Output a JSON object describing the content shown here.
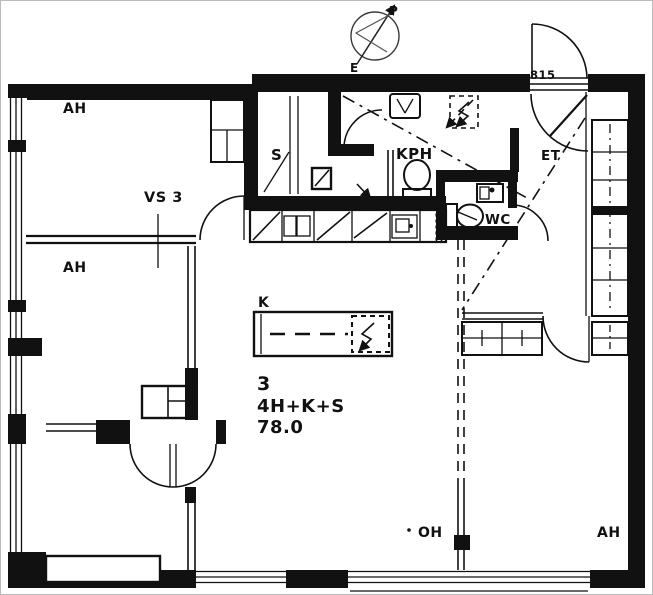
{
  "plan": {
    "compass": {
      "north": "P",
      "south": "E"
    },
    "entry_door_code": "815",
    "rooms": {
      "bedroom_top_left": "AH",
      "bedroom_mid_left": "AH",
      "bedroom_bottom_right": "AH",
      "living_room": "OH",
      "kitchen": "K",
      "sauna": "S",
      "bathroom": "KPH",
      "toilet": "WC",
      "entry_hall": "ET"
    },
    "partition_marker": "VS 3",
    "apartment": {
      "number": "3",
      "layout_type": "4H+K+S",
      "area_m2": "78.0"
    },
    "colors": {
      "ink": "#111111",
      "paper": "#ffffff",
      "scan_border": "#aaaaaa"
    }
  }
}
